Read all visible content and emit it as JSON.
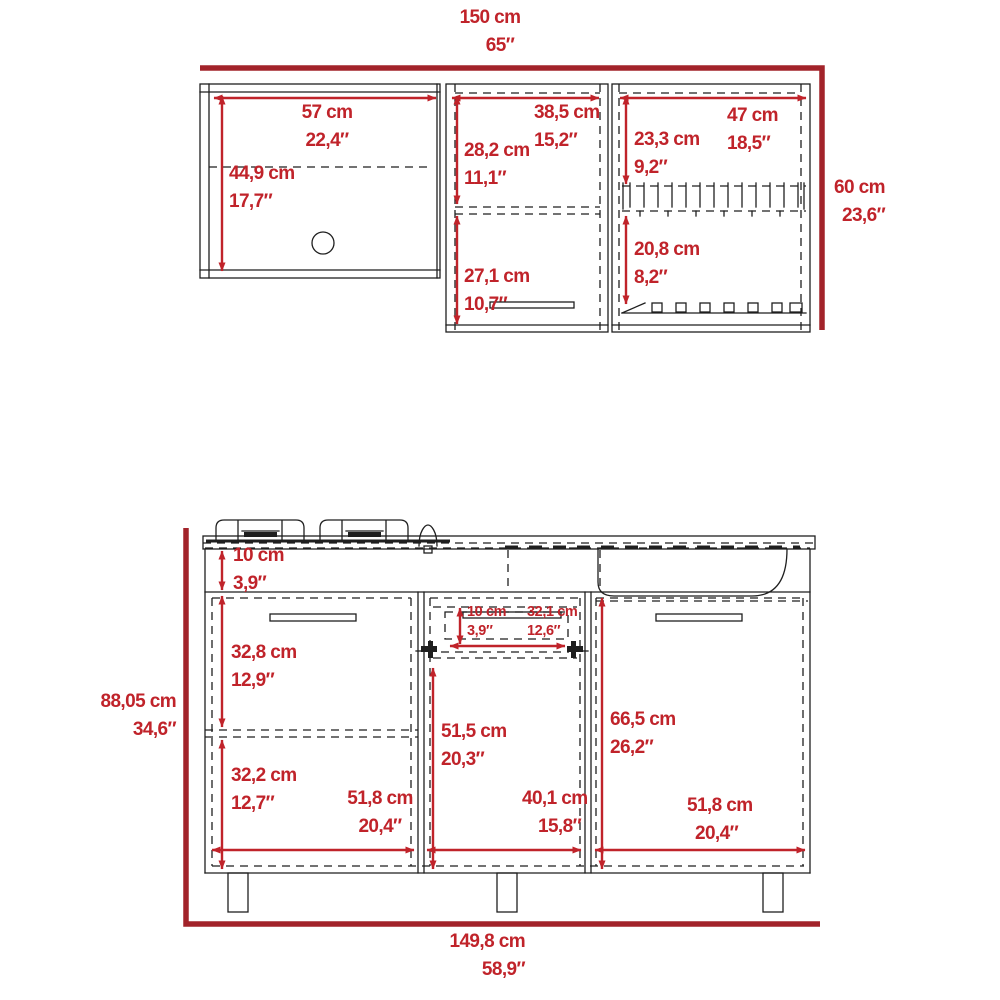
{
  "colors": {
    "dimension_red": "#c0232a",
    "bracket_red": "#a2232a",
    "line_black": "#1f1f1f",
    "background": "#ffffff"
  },
  "overall": {
    "upper_width": {
      "cm": "150 cm",
      "in": "65″"
    },
    "upper_height": {
      "cm": "60 cm",
      "in": "23,6″"
    },
    "lower_height": {
      "cm": "88,05 cm",
      "in": "34,6″"
    },
    "lower_width": {
      "cm": "149,8 cm",
      "in": "58,9″"
    }
  },
  "upper": {
    "left": {
      "width": {
        "cm": "57 cm",
        "in": "22,4″"
      },
      "height": {
        "cm": "44,9 cm",
        "in": "17,7″"
      }
    },
    "middle": {
      "width": {
        "cm": "38,5 cm",
        "in": "15,2″"
      },
      "top_height": {
        "cm": "28,2 cm",
        "in": "11,1″"
      },
      "bottom_height": {
        "cm": "27,1 cm",
        "in": "10,7″"
      }
    },
    "right": {
      "width": {
        "cm": "47 cm",
        "in": "18,5″"
      },
      "top_height": {
        "cm": "23,3 cm",
        "in": "9,2″"
      },
      "bottom_height": {
        "cm": "20,8 cm",
        "in": "8,2″"
      }
    }
  },
  "lower": {
    "countertop_band": {
      "cm": "10 cm",
      "in": "3,9″"
    },
    "left": {
      "top_height": {
        "cm": "32,8 cm",
        "in": "12,9″"
      },
      "bottom_height": {
        "cm": "32,2 cm",
        "in": "12,7″"
      },
      "width": {
        "cm": "51,8 cm",
        "in": "20,4″"
      }
    },
    "middle": {
      "drawer_height": {
        "cm": "10 cm",
        "in": "3,9″"
      },
      "drawer_width": {
        "cm": "32,1 cm",
        "in": "12,6″"
      },
      "door_height": {
        "cm": "51,5 cm",
        "in": "20,3″"
      },
      "width": {
        "cm": "40,1 cm",
        "in": "15,8″"
      }
    },
    "right": {
      "door_height": {
        "cm": "66,5 cm",
        "in": "26,2″"
      },
      "width": {
        "cm": "51,8 cm",
        "in": "20,4″"
      }
    }
  }
}
